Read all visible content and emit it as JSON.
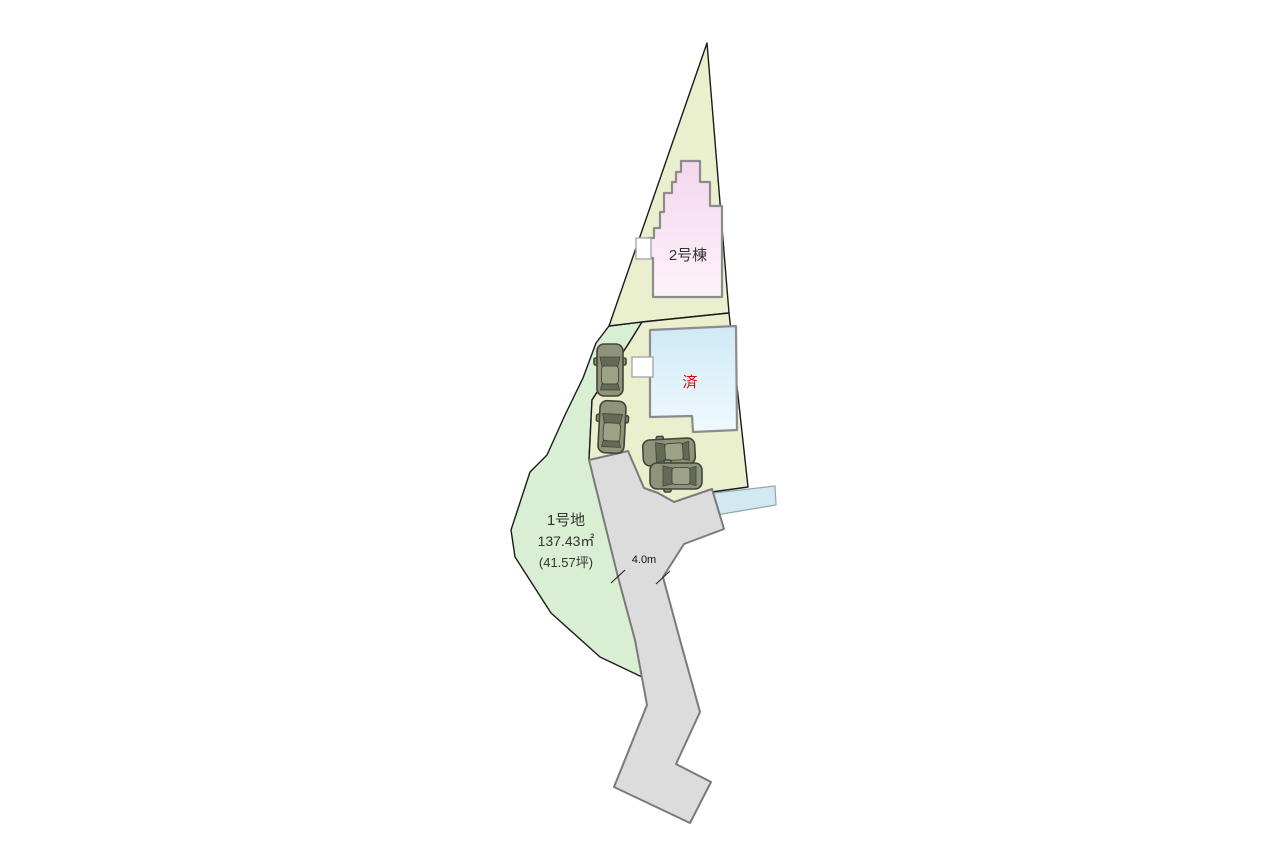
{
  "labels": {
    "building2": "2号棟",
    "sold": "済",
    "lot1_name": "1号地",
    "lot1_area_m2": "137.43㎡",
    "lot1_area_tsubo": "(41.57坪)",
    "road_width": "4.0m"
  },
  "colors": {
    "lot2_green": "#eaefce",
    "lot1_green": "#d9efd3",
    "road_gray": "#dcdcdc",
    "road_border": "#7a7a7a",
    "water_blue": "#d2e9f2",
    "building2_pink": "#f5d6ee",
    "building_sold_blue": "#cfeaf6",
    "building_border": "#8c8c8c",
    "car_body": "#8e9379",
    "sold_text_red": "#dd0000",
    "boundary_black": "#1a1a1a",
    "label_text": "#333333"
  }
}
